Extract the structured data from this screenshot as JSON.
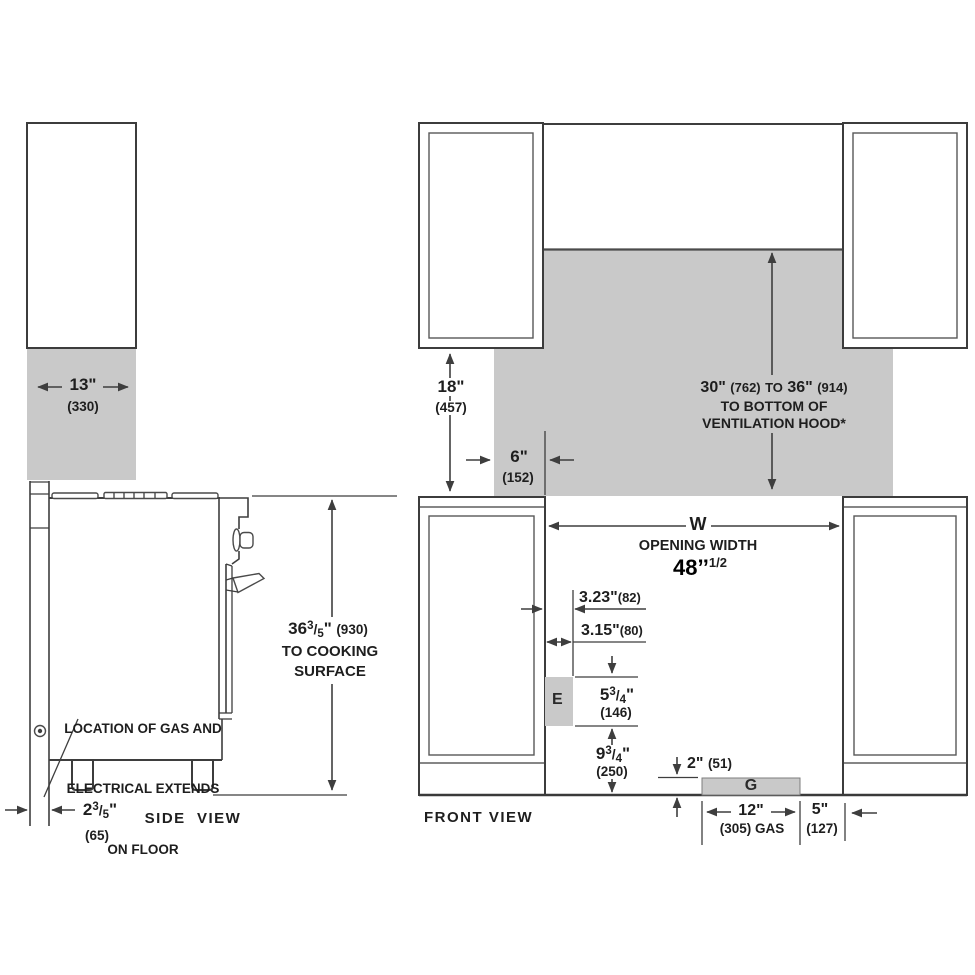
{
  "glyphs": {
    "slash": "/"
  },
  "side_view": {
    "label": "SIDE  VIEW",
    "dim_width": {
      "value": "13\"",
      "mm": "(330)"
    },
    "dim_back_gap": {
      "whole": "2",
      "num": "3",
      "den": "5",
      "unit": "\"",
      "mm": "(65)"
    },
    "dim_height": {
      "whole": "36",
      "num": "3",
      "den": "5",
      "unit": "\"",
      "mm": "(930)",
      "line2": "TO COOKING",
      "line3": "SURFACE"
    },
    "gas_note": {
      "line1": "LOCATION OF GAS AND",
      "line2": "ELECTRICAL EXTENDS",
      "line3": "ON FLOOR"
    }
  },
  "front_view": {
    "label": "FRONT VIEW",
    "dim_cabinet_height": {
      "value": "18\"",
      "mm": "(457)"
    },
    "dim_side_clearance": {
      "value": "6\"",
      "mm": "(152)"
    },
    "hood_clearance": {
      "min": "30\"",
      "min_mm": "(762)",
      "to": "TO",
      "max": "36\"",
      "max_mm": "(914)",
      "line2": "TO BOTTOM OF",
      "line3": "VENTILATION HOOD*"
    },
    "opening": {
      "symbol": "W",
      "label": "OPENING WIDTH",
      "value": "48’’",
      "sup": "1/2"
    },
    "dim_e_offset1": {
      "value": "3.23\"",
      "mm": "(82)"
    },
    "dim_e_offset2": {
      "value": "3.15\"",
      "mm": "(80)"
    },
    "dim_e_height": {
      "whole": "5",
      "num": "3",
      "den": "4",
      "unit": "\"",
      "mm": "(146)"
    },
    "dim_e_floor": {
      "whole": "9",
      "num": "3",
      "den": "4",
      "unit": "\"",
      "mm": "(250)"
    },
    "dim_g_height": {
      "value": "2\"",
      "mm": "(51)"
    },
    "dim_g_width": {
      "value": "12\"",
      "mm": "(305) GAS"
    },
    "dim_g_right": {
      "value": "5\"",
      "mm": "(127)"
    },
    "electrical_label": "E",
    "gas_label": "G"
  }
}
